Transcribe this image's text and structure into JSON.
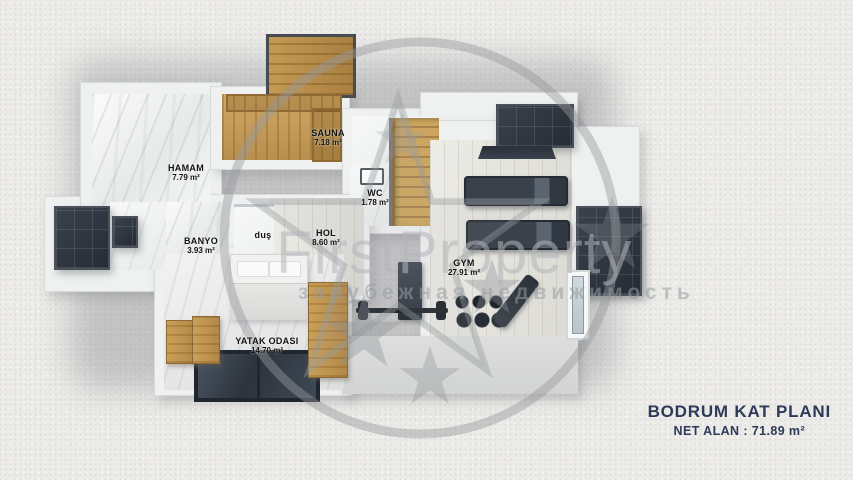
{
  "title": {
    "main": "BODRUM KAT PLANI",
    "sub": "NET ALAN : 71.89 m²"
  },
  "rooms": {
    "hamam": {
      "name": "HAMAM",
      "area": "7.79 m²"
    },
    "sauna": {
      "name": "SAUNA",
      "area": "7.18 m²"
    },
    "wc": {
      "name": "WC",
      "area": "1.78 m²"
    },
    "banyo": {
      "name": "BANYO",
      "area": "3.93 m²"
    },
    "dus": {
      "name": "duş",
      "area": ""
    },
    "hol": {
      "name": "HOL",
      "area": "8.60 m²"
    },
    "gym": {
      "name": "GYM",
      "area": "27.91 m²"
    },
    "yatak_odasi": {
      "name": "YATAK ODASI",
      "area": "14.70 m²"
    }
  },
  "watermark": {
    "brand": "FirstProperty",
    "tagline": "зарубежная недвижимость"
  },
  "colors": {
    "title_text": "#2d3a58",
    "window_panel": "#2e3540",
    "sauna_wood": "#c8a160",
    "background": "#ecebe8"
  }
}
